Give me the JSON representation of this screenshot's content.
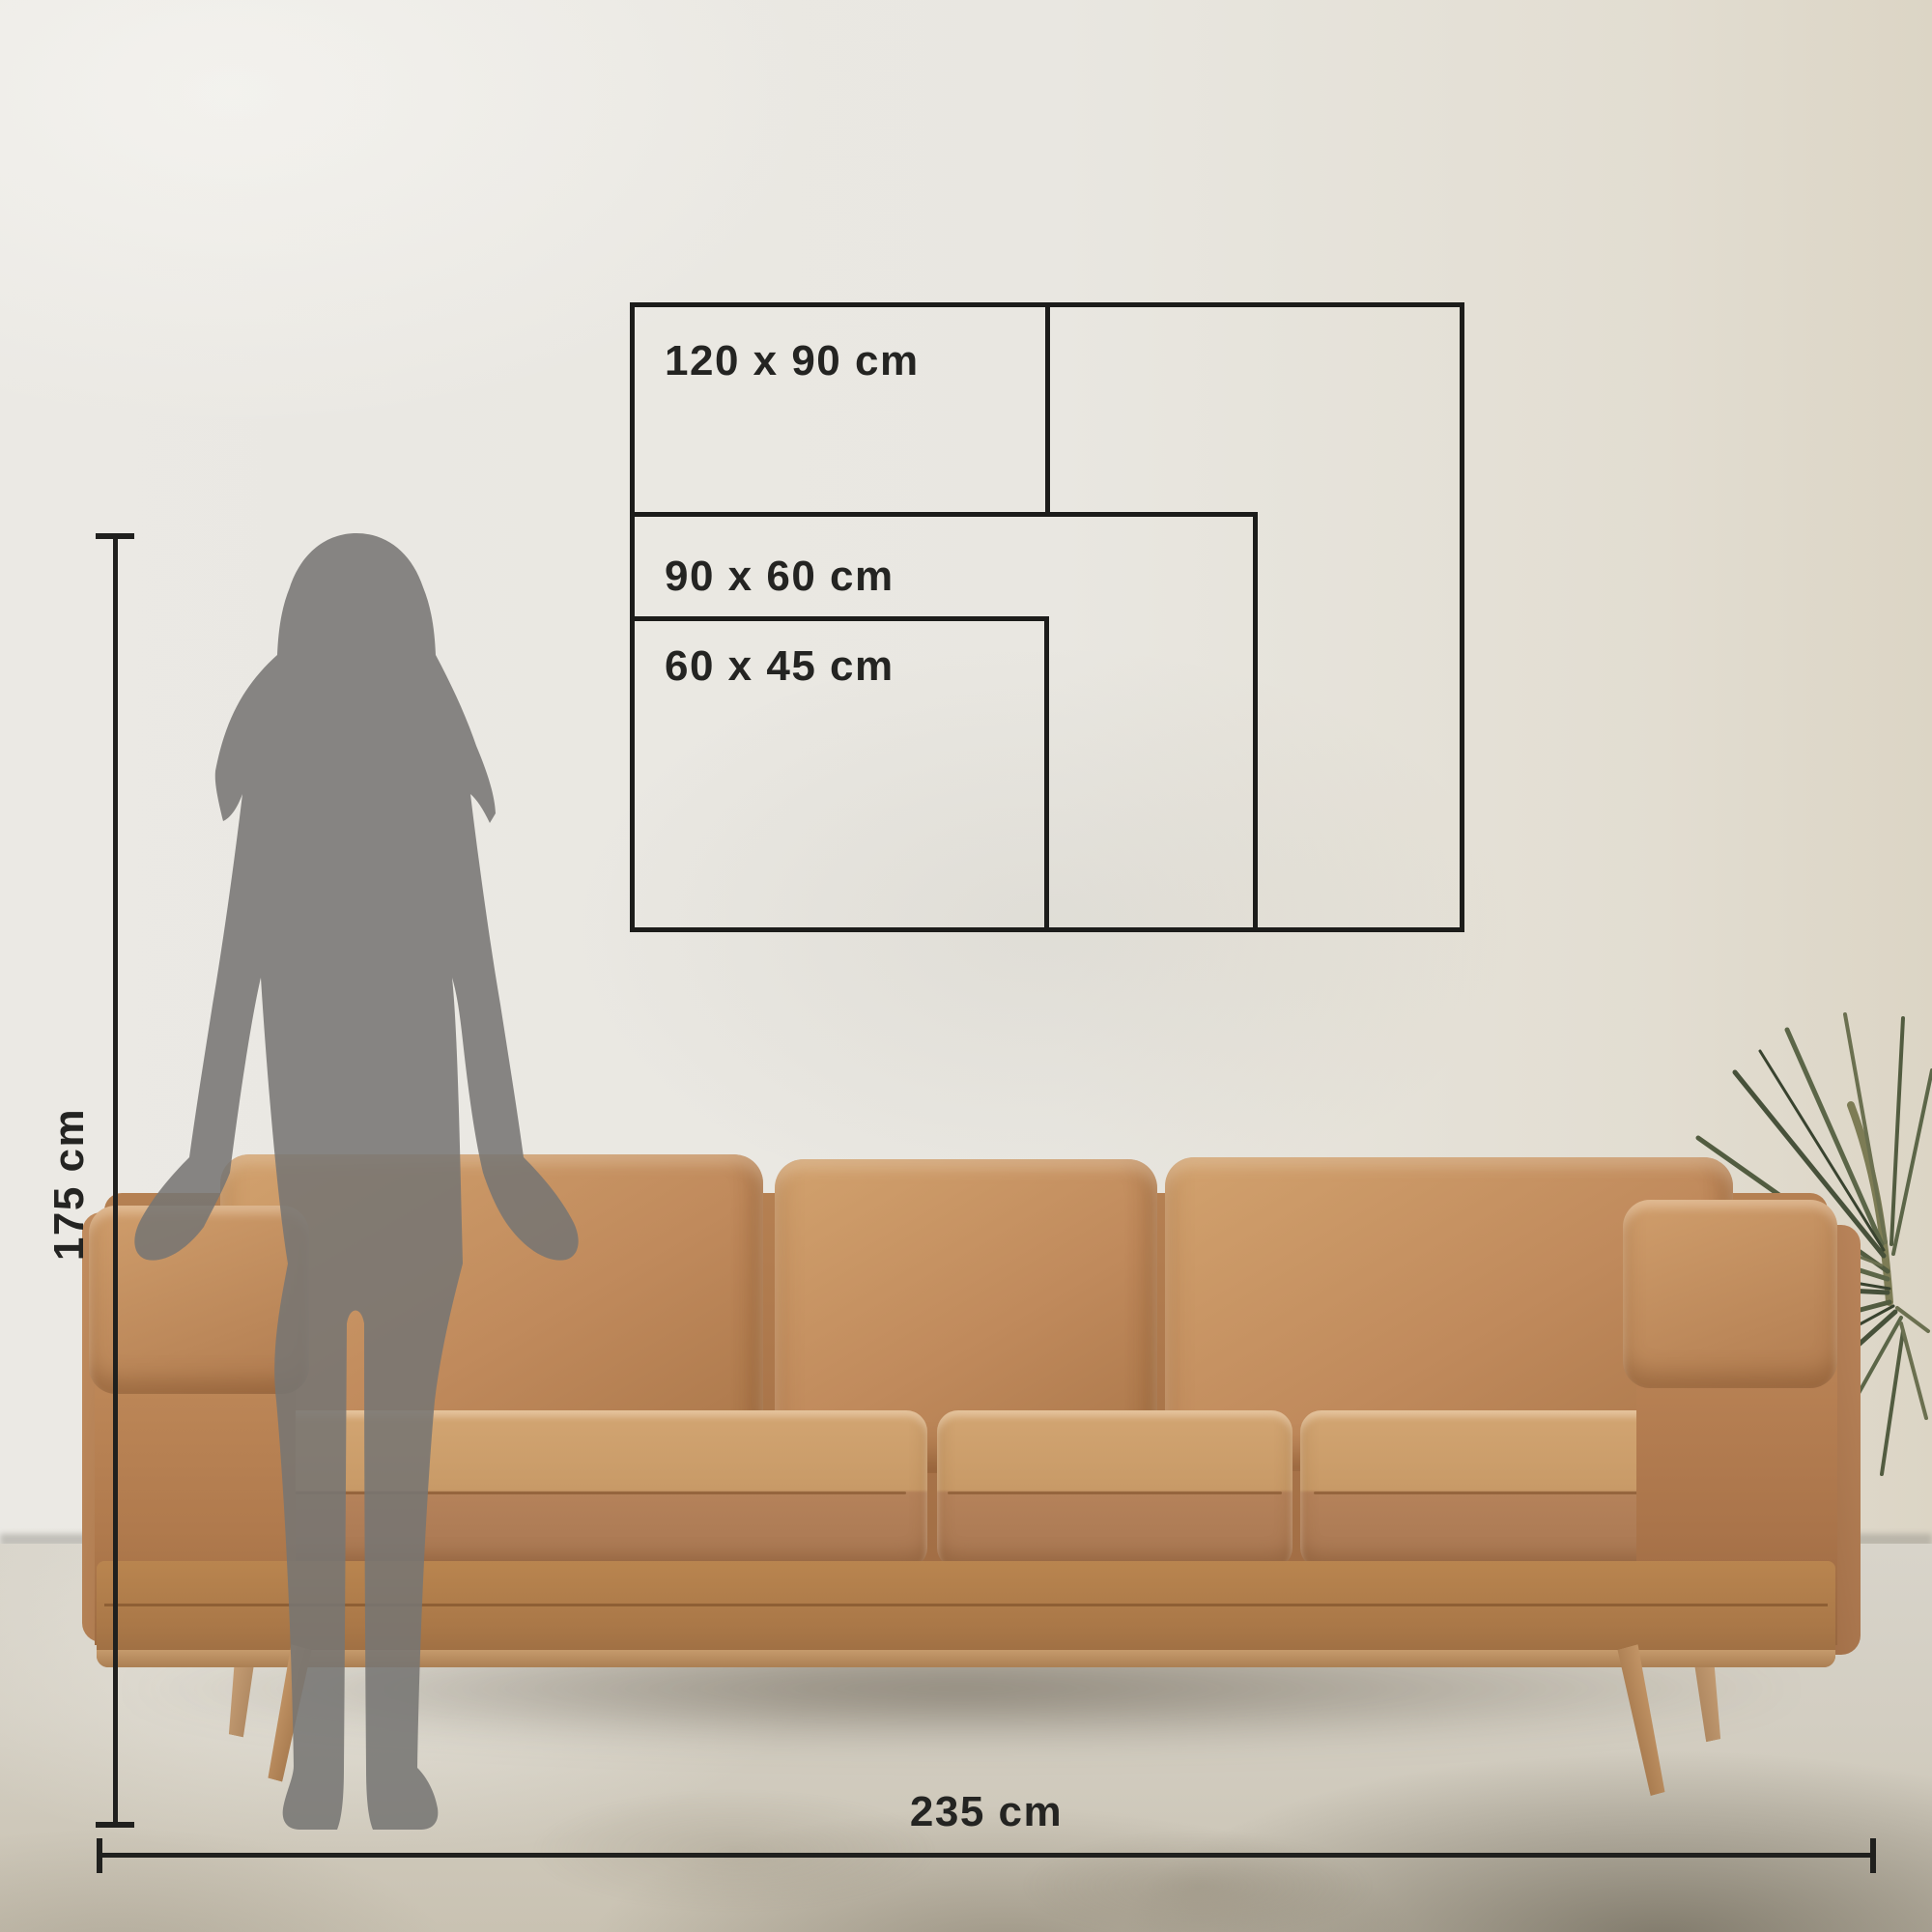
{
  "scene": {
    "description": "Wall-art size guide mockup: living room with leather sofa, standing woman silhouette and print-size rectangles"
  },
  "size_diagram": {
    "boxes": [
      {
        "id": "120x90",
        "label": "120 x 90 cm",
        "width_cm": 120,
        "height_cm": 90
      },
      {
        "id": "90x60",
        "label": "90 x 60 cm",
        "width_cm": 90,
        "height_cm": 60
      },
      {
        "id": "60x45",
        "label": "60 x 45 cm",
        "width_cm": 60,
        "height_cm": 45
      }
    ],
    "line_color": "#1c1c1a"
  },
  "measurements": {
    "person_height": {
      "label": "175 cm",
      "value_cm": 175,
      "orientation": "vertical"
    },
    "sofa_width": {
      "label": "235 cm",
      "value_cm": 235,
      "orientation": "horizontal"
    },
    "line_color": "#20201e"
  },
  "colors": {
    "wall": "#e9e7e1",
    "wall_right": "#dcd5c5",
    "floor": "#d6d2c7",
    "floor_shadow": "#6a6150",
    "outline": "#1c1c1a",
    "label_text": "#242422",
    "silhouette": "#7b7a78",
    "leather": "#c08a5c",
    "leather_highlight": "#d2a26e",
    "leather_shadow": "#9a6b41",
    "wood_leg": "#c09468",
    "plant_green": "#5c6245"
  }
}
